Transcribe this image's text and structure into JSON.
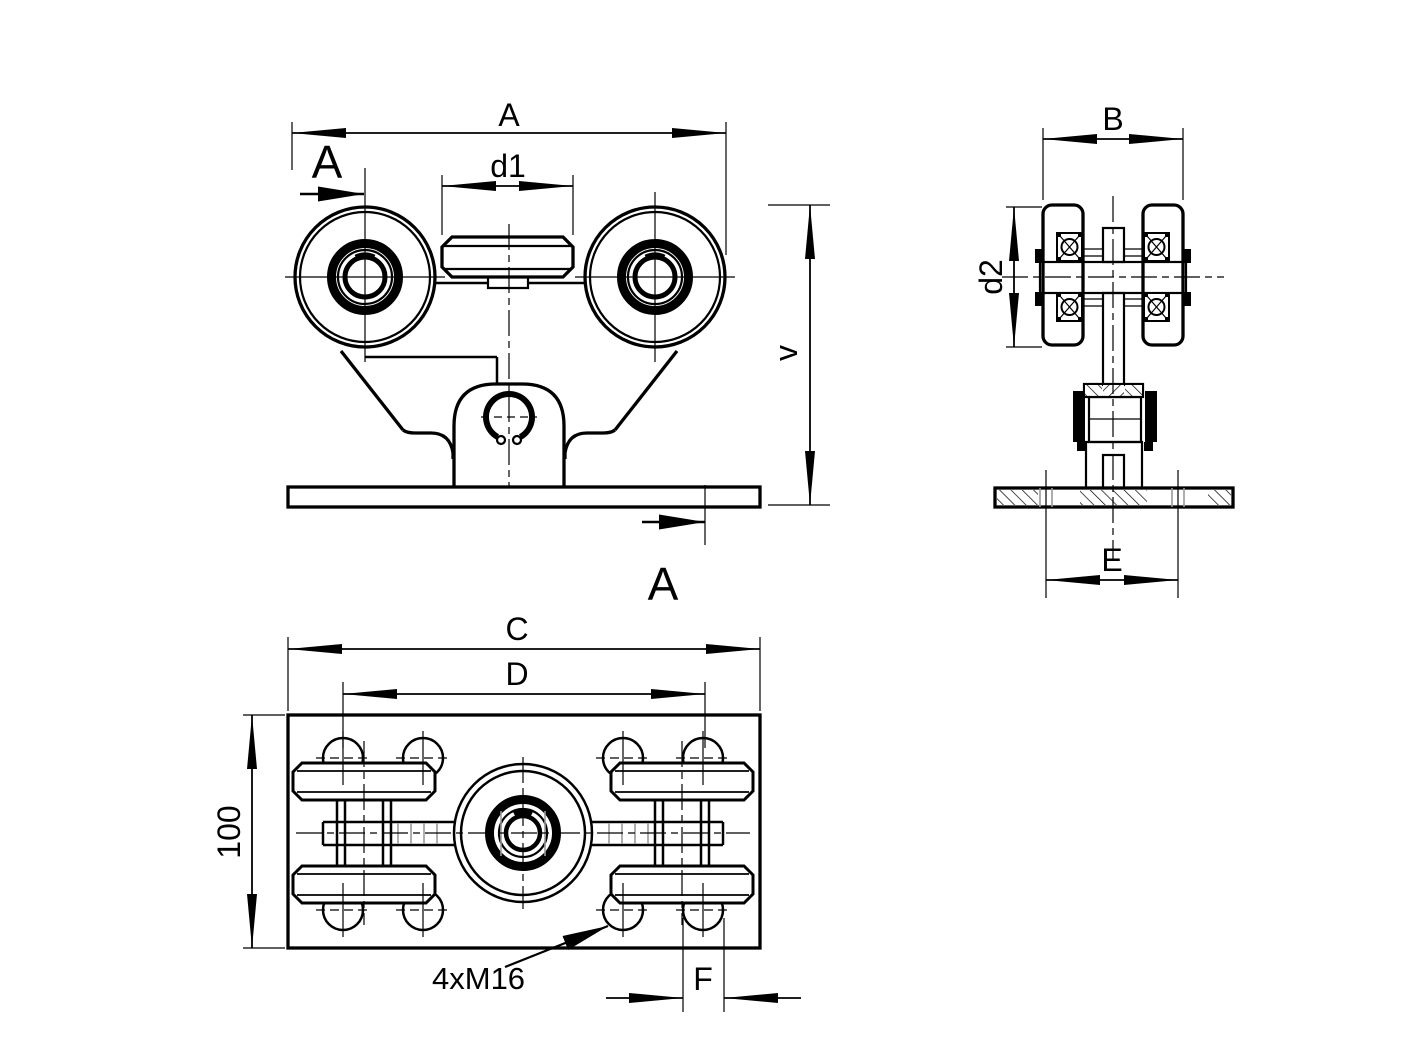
{
  "colors": {
    "line": "#000000",
    "secondary_line": "#9a9a9a",
    "background": "#ffffff"
  },
  "labels": {
    "dim_a": "A",
    "dim_d1": "d1",
    "dim_v": "v",
    "section_top": "A",
    "section_bottom": "A",
    "dim_b": "B",
    "dim_d2": "d2",
    "dim_e": "E",
    "dim_c": "C",
    "dim_d": "D",
    "dim_height": "100",
    "dim_f": "F",
    "thread_note": "4xM16"
  }
}
